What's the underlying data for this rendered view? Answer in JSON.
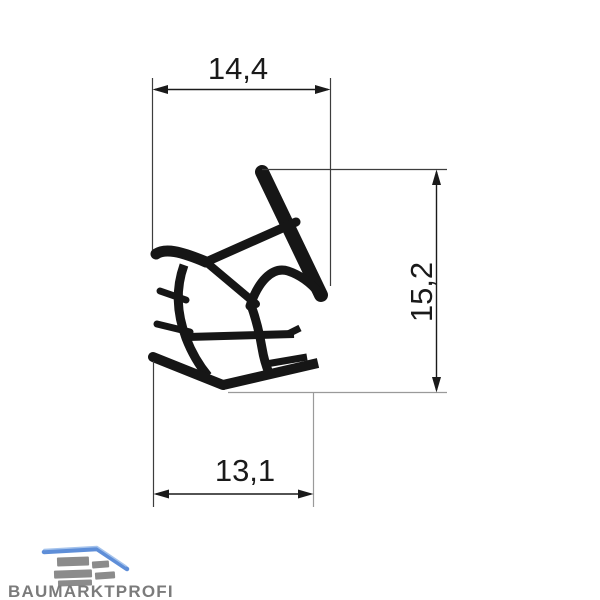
{
  "drawing": {
    "title": "seal-profile-technical-drawing",
    "dimensions": {
      "top_width": "14,4",
      "right_height": "15,2",
      "bottom_width": "13,1"
    },
    "profile_color": "#161616",
    "dimension_line_color": "#1a1a1a",
    "extension_line_color": "#3d3d3d",
    "light_extension_line_color": "#9a9a9a"
  },
  "logo": {
    "brand": "BAUMARKTPROFI",
    "text_color": "#7b7b7b",
    "roof_color": "#5e8ed8",
    "roof_highlight_color": "#a5c3ec",
    "block_color": "#8b8b8b"
  }
}
